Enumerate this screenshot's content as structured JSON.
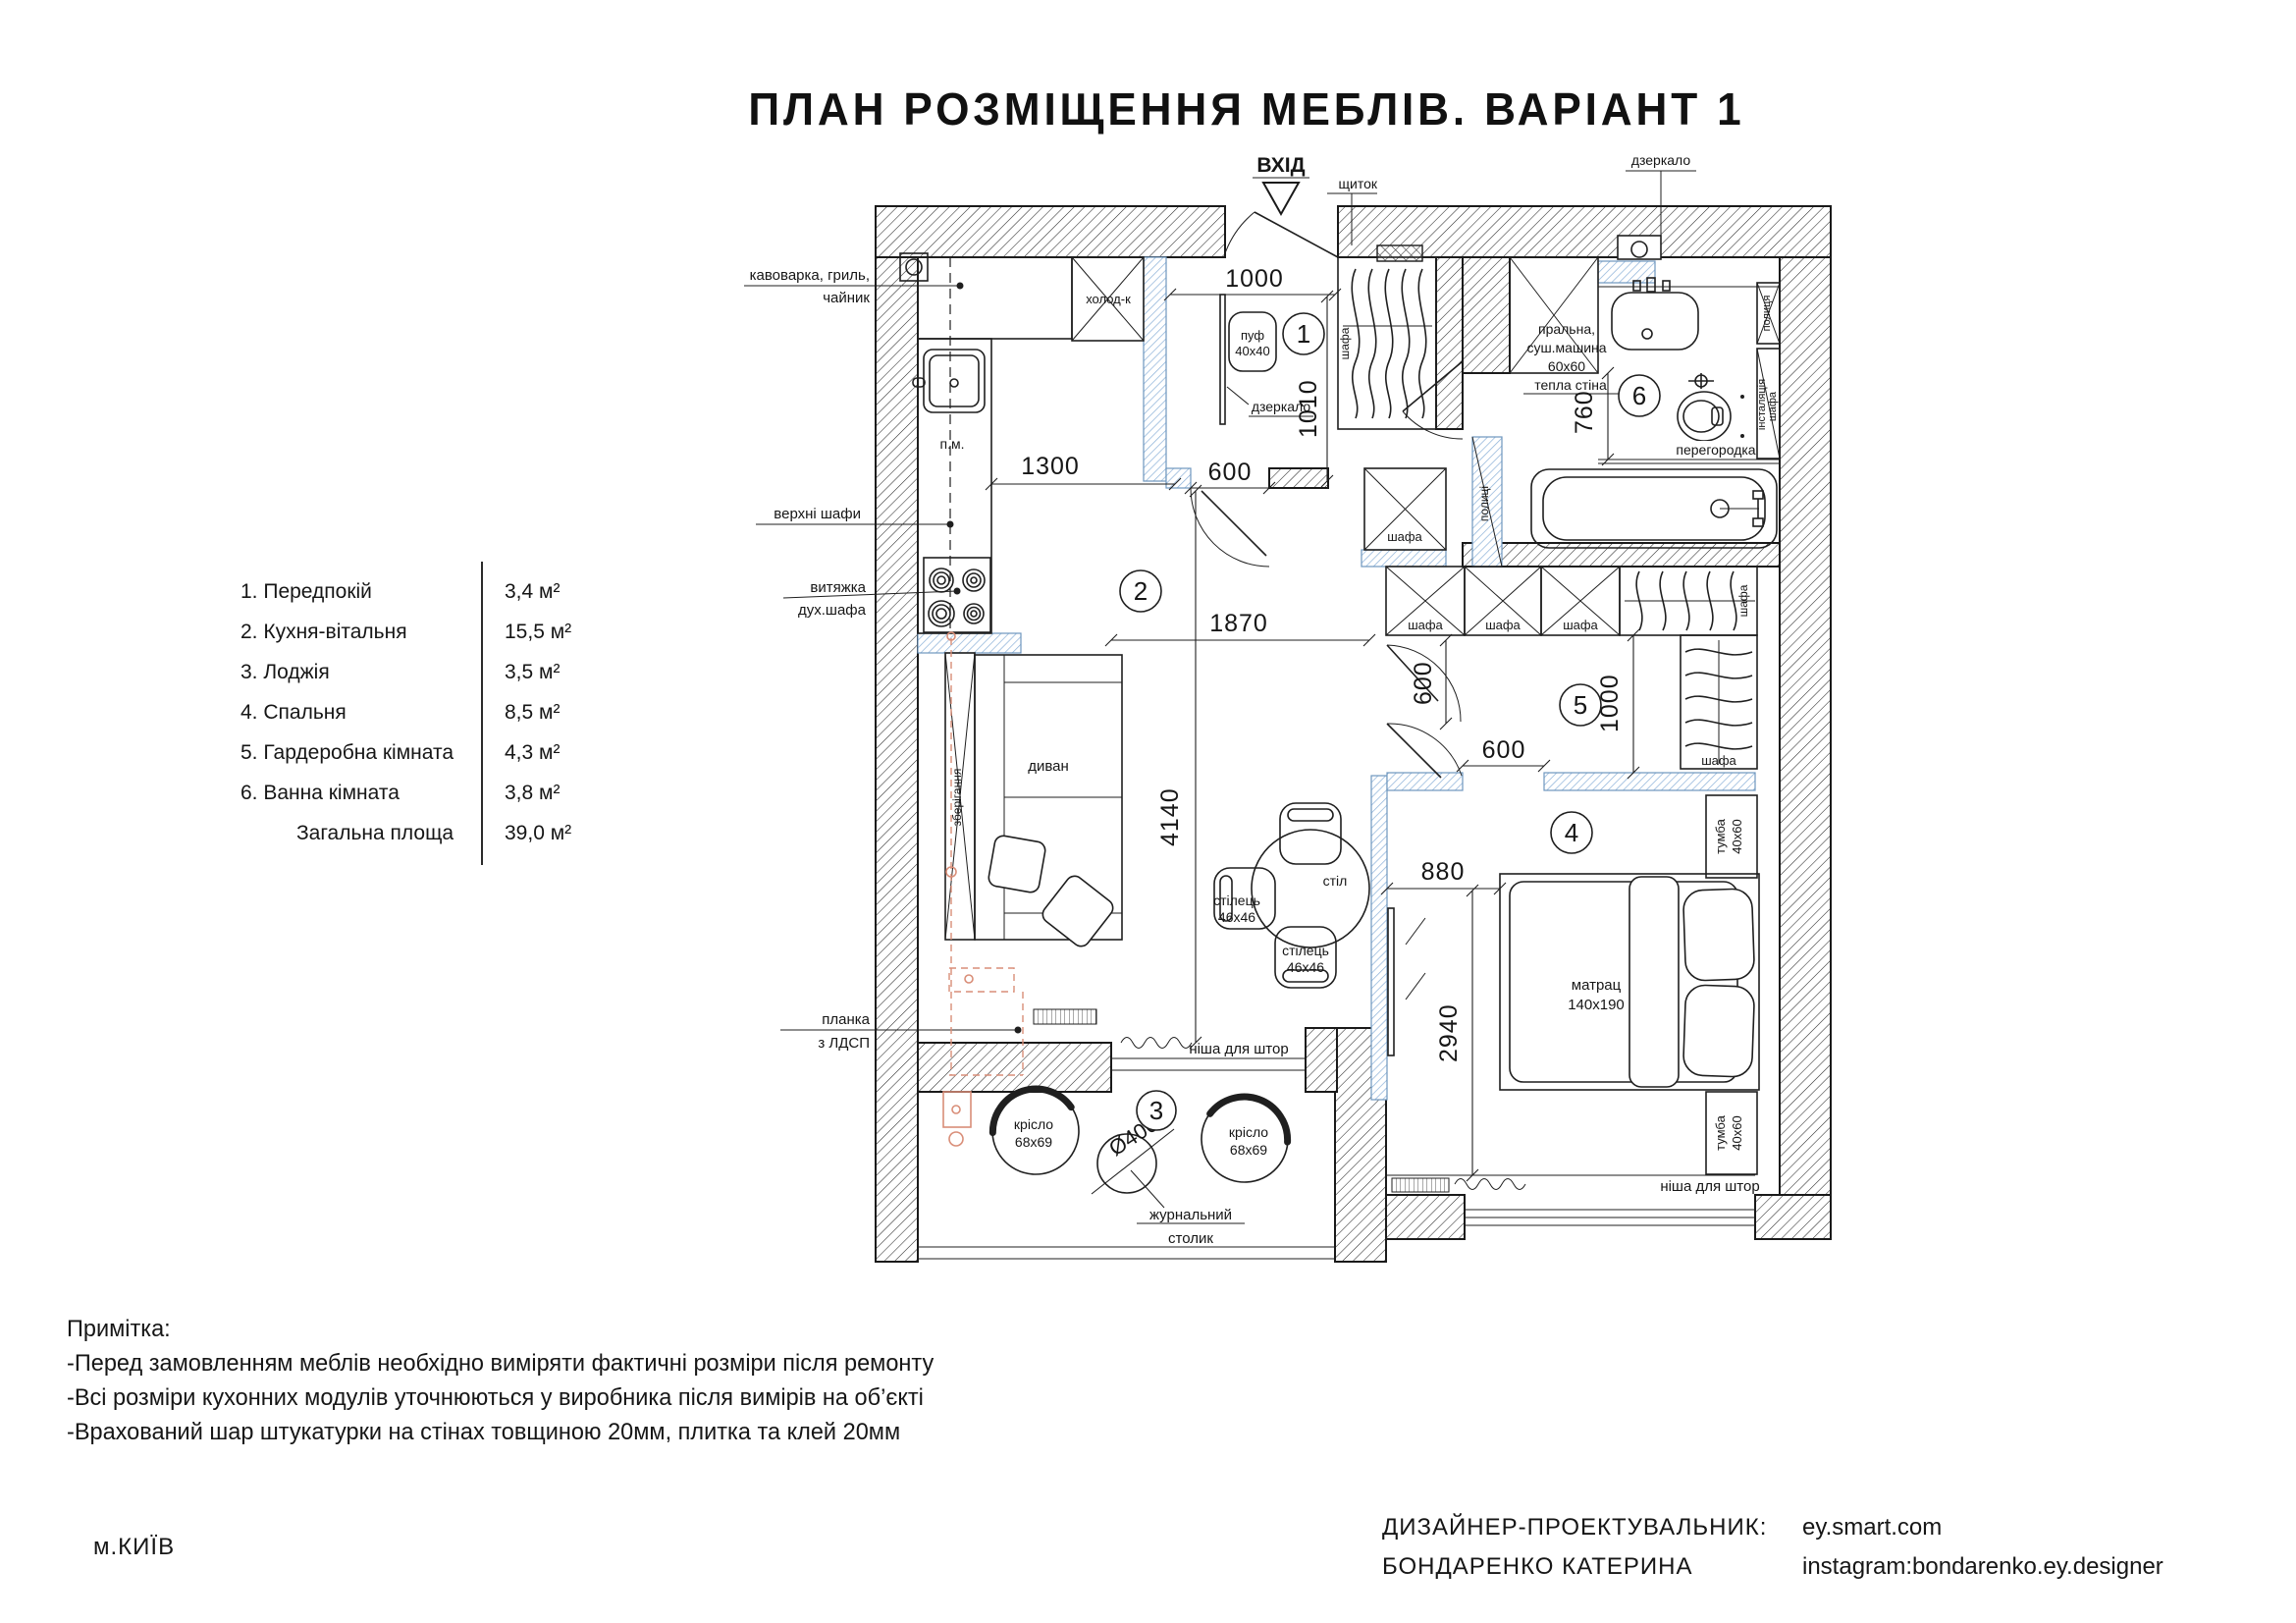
{
  "title": "ПЛАН РОЗМІЩЕННЯ МЕБЛІВ. ВАРІАНТ 1",
  "legend": {
    "rows": [
      {
        "label": "1. Передпокій",
        "area": "3,4 м²"
      },
      {
        "label": "2. Кухня-вітальня",
        "area": "15,5 м²"
      },
      {
        "label": "3. Лоджія",
        "area": "3,5 м²"
      },
      {
        "label": "4. Спальня",
        "area": "8,5 м²"
      },
      {
        "label": "5. Гардеробна кімната",
        "area": "4,3 м²"
      },
      {
        "label": "6. Ванна кімната",
        "area": "3,8 м²"
      }
    ],
    "total_label": "Загальна площа",
    "total_area": "39,0 м²"
  },
  "notes": {
    "heading": "Примітка:",
    "items": [
      "-Перед замовленням меблів необхідно виміряти фактичні розміри після ремонту",
      "-Всі розміри кухонних модулів уточнюються у виробника після вимірів на об’єкті",
      "-Врахований шар штукатурки на стінах товщиною 20мм, плитка та клей 20мм"
    ]
  },
  "footer": {
    "city": "м.КИЇВ",
    "designer_label": "ДИЗАЙНЕР-ПРОЕКТУВАЛЬНИК:",
    "designer_name": "БОНДАРЕНКО КАТЕРИНА",
    "site": "ey.smart.com",
    "instagram": "instagram:bondarenko.ey.designer"
  },
  "plan": {
    "entrance": "ВХІД",
    "rooms": {
      "n1": "1",
      "n2": "2",
      "n3": "3",
      "n4": "4",
      "n5": "5",
      "n6": "6"
    },
    "dims": {
      "a1000": "1000",
      "a1010": "1010",
      "a600": "600",
      "a1300": "1300",
      "a1870": "1870",
      "a4140": "4140",
      "b600": "600",
      "b1000": "1000",
      "c600": "600",
      "a760": "760",
      "a880": "880",
      "a2940": "2940",
      "dia": "Ø400"
    },
    "labels": {
      "shchytok": "щиток",
      "dzerkalo": "дзеркало",
      "kavovarka1": "кавоварка, гриль,",
      "kavovarka2": "чайник",
      "verkhni": "верхні шафи",
      "vytiazhka1": "витяжка",
      "vytiazhka2": "дух.шафа",
      "planka1": "планка",
      "planka2": "з ЛДСП",
      "kholodylnyk": "холод-к",
      "pm": "п.м.",
      "puf1": "пуф",
      "puf2": "40x40",
      "shafa": "шафа",
      "zberihannia": "зберігання",
      "dyvan": "диван",
      "stil": "стіл",
      "stilets1": "стілець",
      "stilets2": "46x46",
      "krislo1": "крісло",
      "krislo2": "68x69",
      "zhurnalnyi1": "журнальний",
      "zhurnalnyi2": "столик",
      "matrats1": "матрац",
      "matrats2": "140x190",
      "tumba1": "тумба",
      "tumba2": "40x60",
      "nisha": "ніша для штор",
      "pralna1": "пральна,",
      "pralna2": "суш.машина",
      "pralna3": "60x60",
      "tepla": "тепла стіна",
      "perehorodka": "перегородка",
      "polytsia": "полиця",
      "polytsi": "полиці",
      "instaliatsiia": "інсталяція"
    }
  }
}
